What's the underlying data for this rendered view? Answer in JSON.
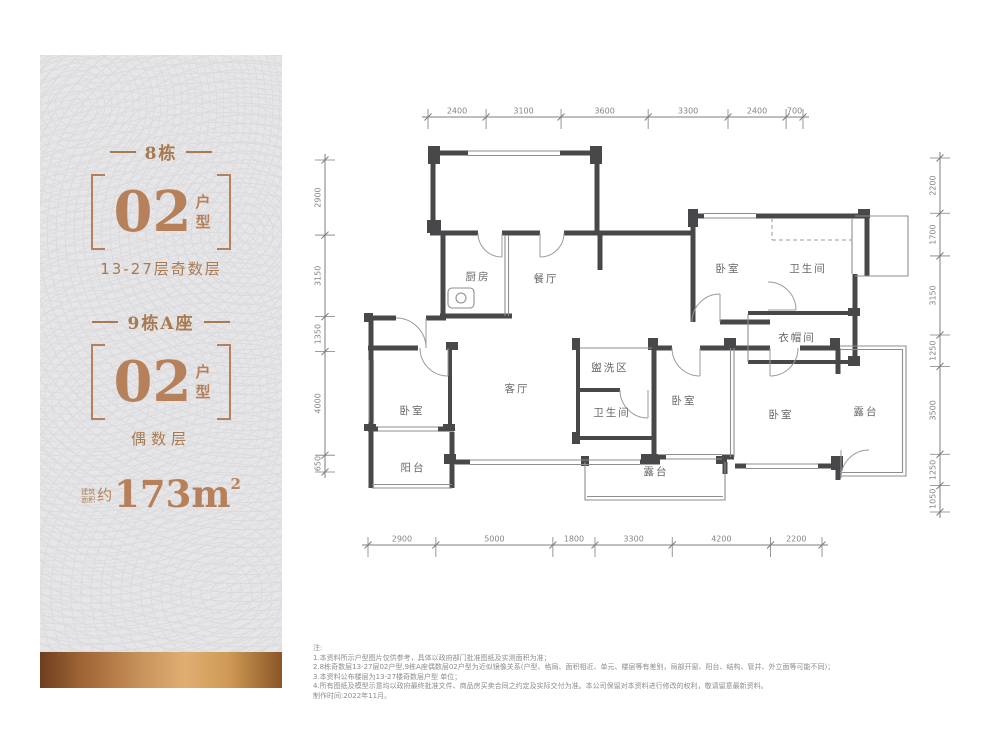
{
  "accent": {
    "copper": "#b5805a",
    "wall": "#48484b",
    "thin_line": "#8e8e91",
    "dim_text": "#85858a",
    "room_text": "#67676b",
    "bar_gradient": [
      "#6e3f1e",
      "#c9935b",
      "#e0ae72",
      "#8a5426"
    ]
  },
  "panel": {
    "blocks": [
      {
        "building": "8栋",
        "unit_number": "02",
        "unit_word_1": "户",
        "unit_word_2": "型",
        "floors": "13-27层奇数层"
      },
      {
        "building": "9栋A座",
        "unit_number": "02",
        "unit_word_1": "户",
        "unit_word_2": "型",
        "floors": "偶数层"
      }
    ],
    "area": {
      "prefix_small_1": "建筑",
      "prefix_small_2": "面积",
      "approx": "约",
      "value": "173m",
      "sup": "2"
    }
  },
  "floorplan": {
    "rooms": [
      {
        "label": "厨房",
        "x": 178,
        "y": 210
      },
      {
        "label": "餐厅",
        "x": 246,
        "y": 212
      },
      {
        "label": "卧室",
        "x": 428,
        "y": 202
      },
      {
        "label": "卫生间",
        "x": 508,
        "y": 202
      },
      {
        "label": "衣帽间",
        "x": 497,
        "y": 271
      },
      {
        "label": "卧室",
        "x": 112,
        "y": 344
      },
      {
        "label": "客厅",
        "x": 217,
        "y": 322
      },
      {
        "label": "盥洗区",
        "x": 310,
        "y": 301
      },
      {
        "label": "卫生间",
        "x": 312,
        "y": 346
      },
      {
        "label": "卧室",
        "x": 384,
        "y": 334
      },
      {
        "label": "卧室",
        "x": 481,
        "y": 348
      },
      {
        "label": "露台",
        "x": 566,
        "y": 345
      },
      {
        "label": "阳台",
        "x": 113,
        "y": 401
      },
      {
        "label": "露台",
        "x": 356,
        "y": 405
      }
    ],
    "dim_lines": [
      {
        "side": "top",
        "orient": "h",
        "pos": 47,
        "from": 128,
        "to": 503,
        "values": [
          "2400",
          "3100",
          "3600",
          "3300",
          "2400",
          "700"
        ]
      },
      {
        "side": "bottom",
        "orient": "h",
        "pos": 475,
        "from": 68,
        "to": 522,
        "values": [
          "2900",
          "5000",
          "1800",
          "3300",
          "4200",
          "2200"
        ]
      },
      {
        "side": "left",
        "orient": "v",
        "pos": 25,
        "from": 90,
        "to": 402,
        "values": [
          "2900",
          "3150",
          "1350",
          "4000",
          "650"
        ]
      },
      {
        "side": "right",
        "orient": "v",
        "pos": 640,
        "from": 88,
        "to": 442,
        "values": [
          "2200",
          "1700",
          "3150",
          "1250",
          "3500",
          "1250",
          "1050"
        ]
      }
    ]
  },
  "notes": {
    "title": "注:",
    "lines": [
      "1.本资料所示户型图片仅供参考，具体以政府部门批准图纸及实测面积为准；",
      "2.8栋奇数层13-27层02户型,9栋A座偶数层02户型为近似镜像关系(户型、格局、面积相近、单元、楼层等有差别，局部开窗、阳台、结构、管井、外立面等可能不同)；",
      "3.本资料公布楼层为13-27楼奇数层户型 单位；",
      "4.所有图纸及模型示意均以政府最终批准文件、商品房买卖合同之约定及实际交付为准。本公司保留对本资料进行修改的权利，敬请留意最新资料。",
      "制作时间:2022年11月。"
    ]
  }
}
